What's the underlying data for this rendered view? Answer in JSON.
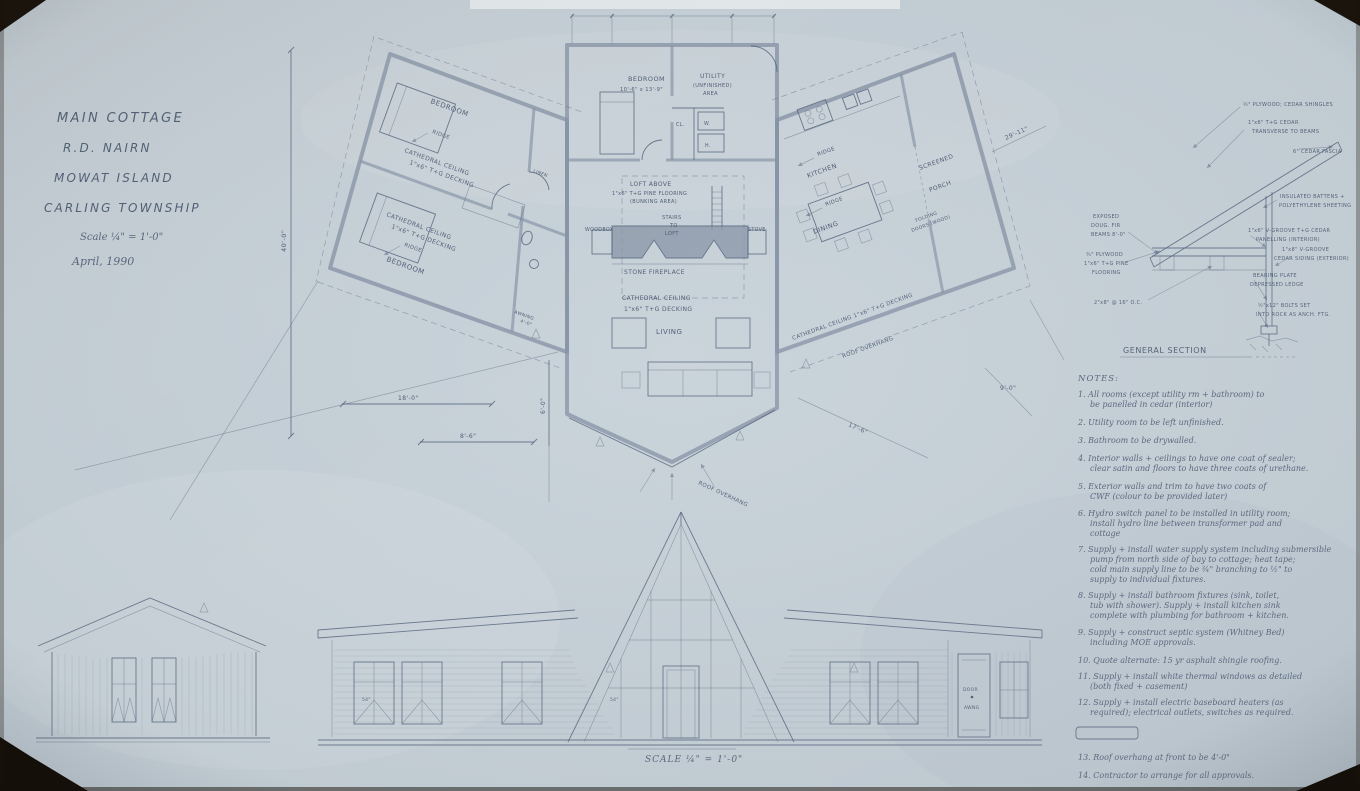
{
  "title_block": {
    "lines": [
      "MAIN COTTAGE",
      "R.D. NAIRN",
      "MOWAT ISLAND",
      "CARLING TOWNSHIP",
      "Scale ¼\" = 1'-0\"",
      "April, 1990"
    ]
  },
  "plan": {
    "center": {
      "bedroom": "BEDROOM",
      "bedroom_dim": "10'-6\" x 13'-9\"",
      "utility": "UTILITY",
      "utility_sub1": "(UNFINISHED)",
      "utility_sub2": "AREA",
      "closet": "CL.",
      "washer": "W.",
      "heater": "H.",
      "loft1": "LOFT ABOVE",
      "loft2": "1\"x6\" T+G PINE FLOORING",
      "loft3": "(BUNKING AREA)",
      "stairs1": "STAIRS",
      "stairs2": "TO",
      "stairs3": "LOFT",
      "woodbox": "WOODBOX",
      "stove": "STOVE",
      "fireplace": "STONE FIREPLACE",
      "ceiling1": "CATHEDRAL CEILING",
      "ceiling2": "1\"x6\" T+G DECKING",
      "living": "LIVING",
      "roof_overhang": "ROOF OVERHANG"
    },
    "left_wing": {
      "bedroom_top": "BEDROOM",
      "bedroom_bottom": "BEDROOM",
      "ridge": "RIDGE",
      "cathedral": "CATHEDRAL CEILING",
      "decking": "1\"x6\" T+G DECKING",
      "linen": "LINEN",
      "awning": "AWNING",
      "awning_dim": "4'-0\""
    },
    "right_wing": {
      "kitchen": "KITCHEN",
      "ridge": "RIDGE",
      "screened": "SCREENED",
      "porch": "PORCH",
      "folding": "FOLDING",
      "doors_wood": "DOORS (WOOD)",
      "dining": "DINING",
      "ceiling": "CATHEDRAL CEILING   1\"x6\" T+G DECKING",
      "roof_overhang": "ROOF OVERHANG"
    },
    "dims": {
      "d40": "40'-0\"",
      "d18": "18'-0\"",
      "d8_6": "8'-6\"",
      "d6": "6'-0\"",
      "d9": "9'-0\"",
      "d17_6": "17'-6\"",
      "d29_11": "29'-11\""
    }
  },
  "section": {
    "title": "GENERAL SECTION",
    "callouts": {
      "exposed1": "EXPOSED",
      "exposed2": "DOUG. FIR",
      "exposed3": "BEAMS 8'-0\"",
      "ply1": "¾\" PLYWOOD",
      "ply2": "1\"x6\" T+G PINE",
      "ply3": "FLOORING",
      "joists": "2\"x8\" @ 16\" O.C.",
      "shingles": "½\" PLYWOOD; CEDAR SHINGLES",
      "cedar1": "1\"x6\" T+G CEDAR",
      "cedar2": "TRANSVERSE TO BEAMS",
      "fascia": "6\" CEDAR FASCIA",
      "batten1": "INSULATED BATTENS +",
      "batten2": "POLYETHYLENE SHEETING",
      "panel1": "1\"x6\" V-GROOVE T+G CEDAR",
      "panel2": "PANELLING (INTERIOR)",
      "siding1": "1\"x8\" V-GROOVE",
      "siding2": "CEDAR SIDING (EXTERIOR)",
      "plate1": "BEARING PLATE",
      "plate2": "DEPRESSED LEDGE",
      "bolts1": "½\"x12\" BOLTS SET",
      "bolts2": "INTO ROCK AS ANCH. FTG."
    }
  },
  "notes": {
    "heading": "NOTES:",
    "items": [
      {
        "lines": [
          "1.  All rooms (except utility rm + bathroom) to",
          "be panelled in cedar (interior)"
        ]
      },
      {
        "lines": [
          "2.  Utility room to be left unfinished."
        ]
      },
      {
        "lines": [
          "3.  Bathroom to be drywalled."
        ]
      },
      {
        "lines": [
          "4.  Interior walls + ceilings to have one coat of sealer;",
          "clear satin and floors to have three coats of urethane."
        ]
      },
      {
        "lines": [
          "5.  Exterior walls and trim to have two coats of",
          "CWF (colour to be provided later)"
        ]
      },
      {
        "lines": [
          "6.  Hydro switch panel to be installed in utility room;",
          "install hydro line between transformer pad and",
          "cottage"
        ]
      },
      {
        "lines": [
          "7.  Supply + install water supply system including submersible",
          "pump from north side of bay to cottage; heat tape;",
          "cold main supply line to be ¾\" branching to ½\" to",
          "supply to individual fixtures."
        ]
      },
      {
        "lines": [
          "8.  Supply + install bathroom fixtures (sink, toilet,",
          "tub with shower).  Supply + install kitchen sink",
          "complete with plumbing for bathroom + kitchen."
        ]
      },
      {
        "lines": [
          "9.  Supply + construct septic system (Whitney Bed)",
          "including MOE approvals."
        ]
      },
      {
        "lines": [
          "10. Quote alternate:  15 yr asphalt shingle roofing."
        ]
      },
      {
        "lines": [
          "11. Supply + install white thermal windows as detailed",
          "(both fixed + casement)"
        ]
      },
      {
        "lines": [
          "12. Supply + install electric baseboard heaters (as",
          "required); electrical outlets, switches as required."
        ]
      },
      {
        "lines": [
          "13. Roof overhang at front to be 4'-0\""
        ]
      },
      {
        "lines": [
          "14. Contractor to arrange for all approvals."
        ]
      }
    ]
  },
  "elevations": {
    "scale_label": "SCALE ¼\" = 1'-0\"",
    "window_size": "54\"",
    "door_label": "DOOR",
    "awning_label": "AWNG"
  }
}
